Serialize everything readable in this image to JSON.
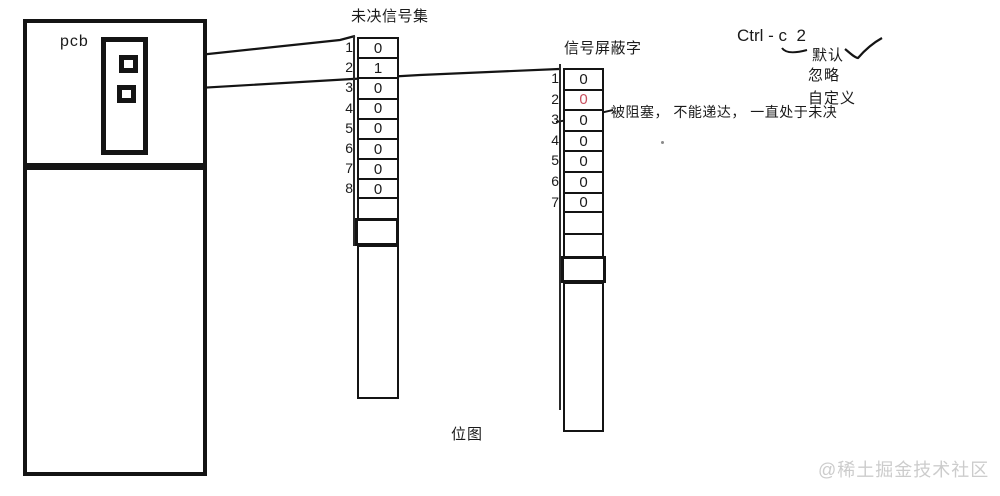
{
  "pcb": {
    "label": "pcb"
  },
  "pending_set": {
    "title": "未决信号集",
    "cells": [
      {
        "n": "1",
        "v": "0",
        "red": false
      },
      {
        "n": "2",
        "v": "1",
        "red": false
      },
      {
        "n": "3",
        "v": "0",
        "red": false
      },
      {
        "n": "4",
        "v": "0",
        "red": false
      },
      {
        "n": "5",
        "v": "0",
        "red": false
      },
      {
        "n": "6",
        "v": "0",
        "red": false
      },
      {
        "n": "7",
        "v": "0",
        "red": false
      },
      {
        "n": "8",
        "v": "0",
        "red": false
      }
    ]
  },
  "mask_word": {
    "title": "信号屏蔽字",
    "cells": [
      {
        "n": "1",
        "v": "0",
        "red": false
      },
      {
        "n": "2",
        "v": "0",
        "red": true
      },
      {
        "n": "3",
        "v": "0",
        "red": false
      },
      {
        "n": "4",
        "v": "0",
        "red": false
      },
      {
        "n": "5",
        "v": "0",
        "red": false
      },
      {
        "n": "6",
        "v": "0",
        "red": false
      },
      {
        "n": "7",
        "v": "0",
        "red": false
      }
    ]
  },
  "annotation": {
    "blocked_note": "被阻塞， 不能递达， 一直处于未决"
  },
  "shortcut": {
    "label": "Ctrl - c  2"
  },
  "options": {
    "default": "默认",
    "ignore": "忽略",
    "custom": "自定义"
  },
  "bitmap_label": "位图",
  "watermark": "@稀土掘金技术社区",
  "colors": {
    "ink": "#141414",
    "red_value": "#c8505f",
    "watermark": "#cccccc"
  }
}
